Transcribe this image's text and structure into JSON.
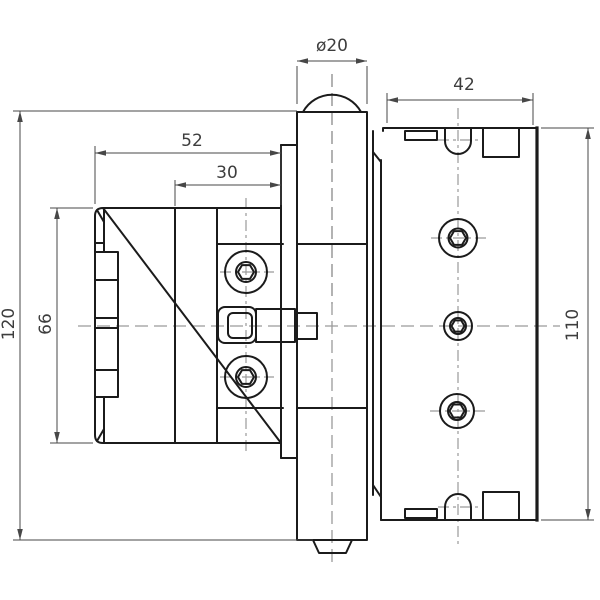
{
  "drawing": {
    "kind": "technical-drawing",
    "subject": "hinge-side-view",
    "line_color": "#1b1b1b",
    "dim_color": "#474747",
    "centerline_color": "#9a9a9a",
    "dimensions": {
      "pin_diameter": "ø20",
      "plate_width": "42",
      "body_width": "52",
      "body_inner_width": "30",
      "pin_height": "120",
      "body_height": "66",
      "plate_height": "110"
    }
  }
}
